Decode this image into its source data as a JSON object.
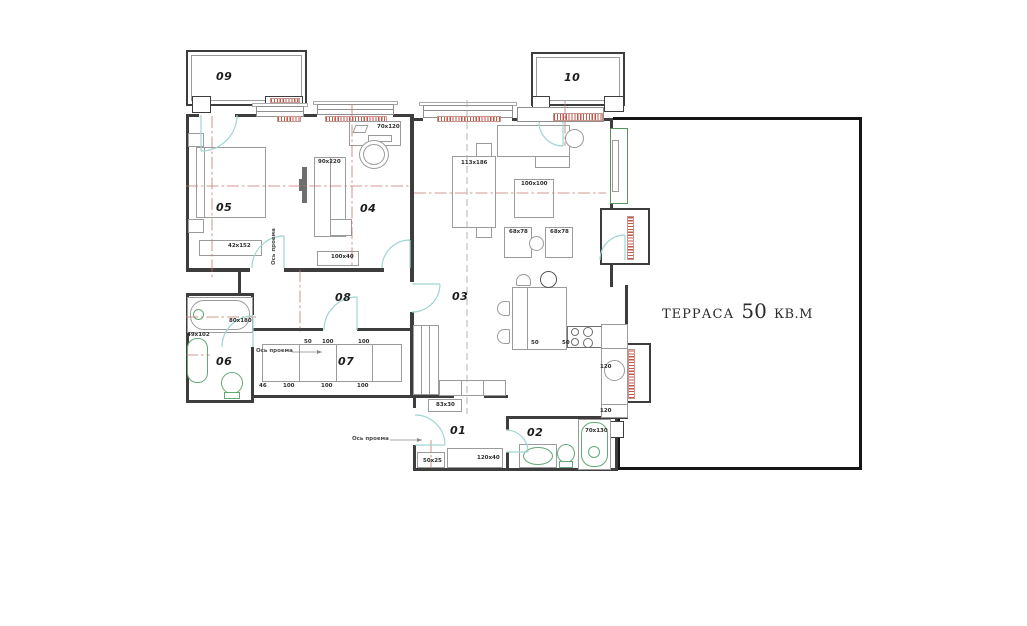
{
  "terrace": {
    "name": "ТЕРРАСА",
    "area": "50",
    "unit": "КВ.М"
  },
  "rooms": {
    "r01": "01",
    "r02": "02",
    "r03": "03",
    "r04": "04",
    "r05": "05",
    "r06": "06",
    "r07": "07",
    "r08": "08",
    "r09": "09",
    "r10": "10"
  },
  "dims": {
    "dresser05": "42x152",
    "wardrobe04": "90x220",
    "desk04": "70x120",
    "bench04": "100x40",
    "sofa03": "113x186",
    "table03": "100x100",
    "chair03l": "68x78",
    "chair03r": "68x78",
    "tub06": "80x180",
    "sink06": "49x102",
    "cab01": "83x30",
    "bench01": "50x25",
    "closet01": "120x40",
    "tub02": "70x130",
    "k50a": "50",
    "k50b": "50",
    "k120a": "120",
    "k120b": "120"
  },
  "wardrobe07": {
    "top": [
      "50",
      "100",
      "100"
    ],
    "bottom": [
      "46",
      "100",
      "100",
      "100"
    ]
  },
  "axis_label": "Ось проема",
  "colors": {
    "wall": "#3d3d3d",
    "terrace_border": "#161616",
    "furniture": "#9b9b9b",
    "fixture_green": "#63a877",
    "door_teal": "#9fd6d2",
    "radiator_red": "#c4564a",
    "centerline_red": "#c1796d"
  }
}
